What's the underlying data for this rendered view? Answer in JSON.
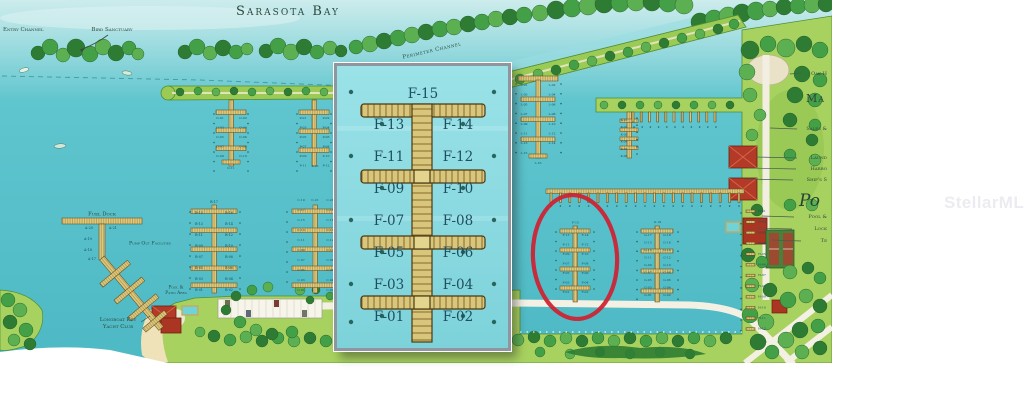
{
  "watermark": "StellarMLS",
  "map": {
    "bay_title": "Sarasota Bay",
    "labels": {
      "entry_channel": "Entry Channel",
      "bird_sanctuary": "Bird Sanctuary",
      "perimeter_channel": "Perimeter Channel",
      "fuel_dock": "Fuel Dock",
      "pump_out_facilities": "Pump Out Facilities",
      "yacht_club": [
        "Longboat Key",
        "Yacht Club"
      ],
      "pool_patio": [
        "Pool &",
        "Patio Area"
      ]
    },
    "right_edge_labels": {
      "oak": "Oak H",
      "marina": "Ma",
      "sales": "Sales &",
      "laundry": "Laund",
      "harbor": "Harbo",
      "ships_store": "Ship's S",
      "script_po": "Po",
      "pool": "Pool &",
      "lockers": "Lock",
      "tennis": "Te"
    },
    "docks": {
      "a": [
        "A-17",
        "A-18",
        "A-19",
        "A-20",
        "A-21"
      ],
      "b": [
        "B-01",
        "B-02",
        "B-03",
        "B-04",
        "B-05",
        "B-06",
        "B-07",
        "B-08",
        "B-09",
        "B-10",
        "B-11",
        "B-12",
        "B-13",
        "B-14",
        "B-15",
        "B-16",
        "B-17"
      ],
      "c": [
        "C-01",
        "C-02",
        "C-03",
        "C-04",
        "C-05",
        "C-06",
        "C-07",
        "C-08",
        "C-09",
        "C-10",
        "C-11",
        "C-12",
        "C-13",
        "C-14",
        "C-15",
        "C-16",
        "C-17",
        "C-18",
        "C-19",
        "C-20",
        "C-21"
      ],
      "o": [
        "O-01",
        "O-02",
        "O-03",
        "O-04",
        "O-05",
        "O-06",
        "O-07",
        "O-08",
        "O-09",
        "O-10",
        "O-11"
      ],
      "p": [
        "P-01",
        "P-02",
        "P-03",
        "P-04",
        "P-05",
        "P-06",
        "P-07",
        "P-08",
        "P-09",
        "P-10",
        "P-11",
        "P-12",
        "P-13"
      ],
      "l": [
        "L-01",
        "L-02",
        "L-03",
        "L-04",
        "L-05",
        "L-06",
        "L-07",
        "L-08",
        "L-09",
        "L-10",
        "L-11",
        "L-12",
        "L-13",
        "L-14",
        "L-15",
        "L-16"
      ],
      "k": [
        "K-01",
        "K-02",
        "K-03",
        "K-04",
        "K-05",
        "K-06"
      ],
      "g": [
        "G-01",
        "G-02",
        "G-03",
        "G-04",
        "G-05",
        "G-06",
        "G-07",
        "G-08",
        "G-09",
        "G-10",
        "G-11",
        "G-12",
        "G-13",
        "G-14",
        "G-15",
        "G-16",
        "G-17",
        "G-18",
        "G-19"
      ],
      "h": [
        "H-01",
        "H-02",
        "H-03",
        "H-04",
        "H-05",
        "H-06",
        "H-07",
        "H-08",
        "H-09",
        "H-10",
        "H-11",
        "H-12"
      ],
      "f": [
        "F-01",
        "F-02",
        "F-03",
        "F-04",
        "F-05",
        "F-06",
        "F-07",
        "F-08",
        "F-09",
        "F-10",
        "F-11",
        "F-12",
        "F-13",
        "F-14",
        "F-15"
      ]
    },
    "highlight_color": "#cf2030"
  }
}
